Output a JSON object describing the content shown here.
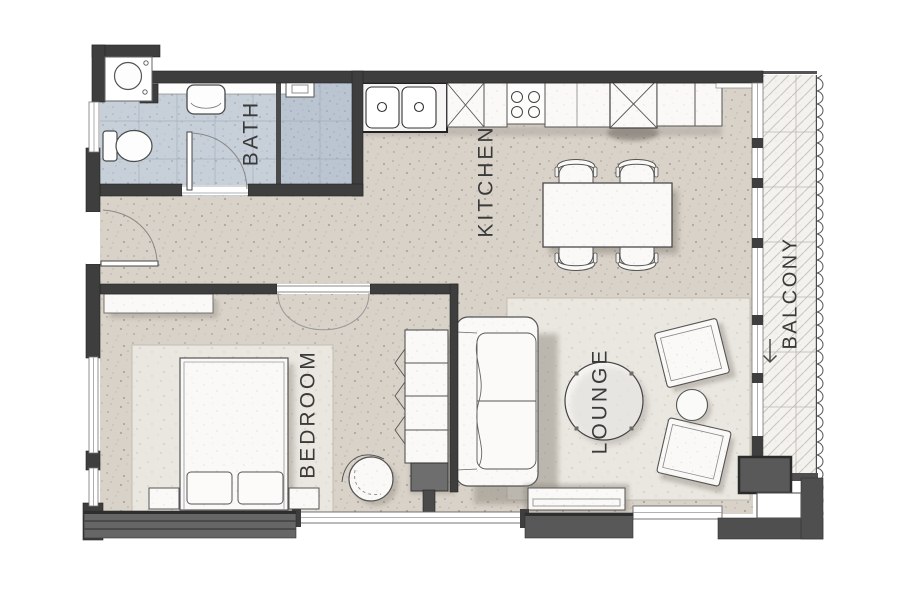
{
  "meta": {
    "type": "apartment-floor-plan"
  },
  "rooms": {
    "bath": {
      "label": "BATH"
    },
    "kitchen": {
      "label": "KITCHEN"
    },
    "bedroom": {
      "label": "BEDROOM"
    },
    "lounge": {
      "label": "LOUNGE"
    },
    "balcony": {
      "label": "BALCONY"
    }
  },
  "colors": {
    "background": "#ffffff",
    "wall": "#3e3e3e",
    "floor": "#d8d2c9",
    "bath_tile": "#c7d0d9",
    "shower_tile": "#bac5d1",
    "rug": "#eae7e1",
    "furniture": "#faf9f7",
    "balcony_floor": "#f3f2ef"
  }
}
